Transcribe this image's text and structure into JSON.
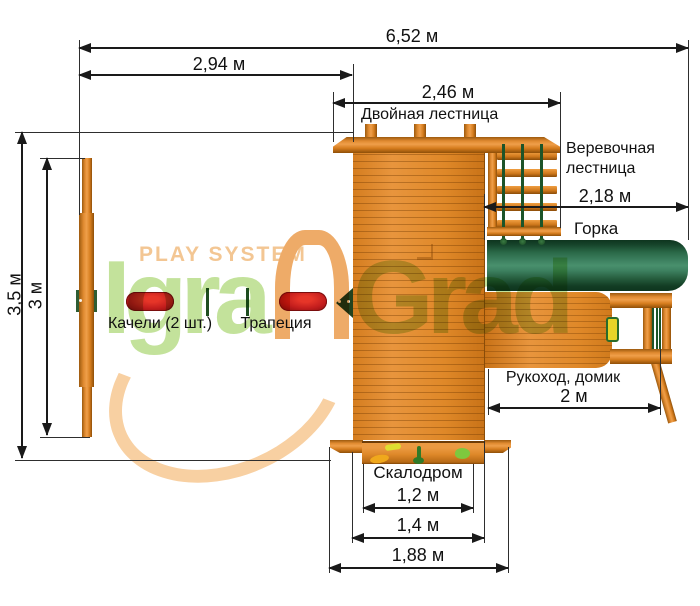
{
  "watermark": {
    "brand_line": "PLAY SYSTEM",
    "logo_left": "Igra",
    "logo_right": "Grad"
  },
  "dimensions": {
    "total_width": "6,52 м",
    "swing_span": "2,94 м",
    "ladder_span": "2,46 м",
    "slide_span": "2,18 м",
    "depth_outer": "3,5 м",
    "depth_inner": "3 м",
    "monkeybar_span": "2 м",
    "climb_inner": "1,2 м",
    "climb_mid": "1,4 м",
    "climb_outer": "1,88 м"
  },
  "labels": {
    "double_ladder": "Двойная лестница",
    "rope_ladder": "Веревочная лестница",
    "slide": "Горка",
    "swings": "Качели (2 шт.)",
    "trapeze": "Трапеция",
    "monkeybar_house": "Рукоход, домик",
    "climbing_wall": "Скалодром"
  },
  "colors": {
    "wood": "#DD8728",
    "wood_dark": "#8F4F08",
    "slide_green": "#1D5737",
    "seat_red": "#C21D1D",
    "rope_green": "#1D5429",
    "dimension_ink": "#1A1A1A",
    "watermark_green": "#C3E29B",
    "watermark_peach": "#F3C693"
  }
}
